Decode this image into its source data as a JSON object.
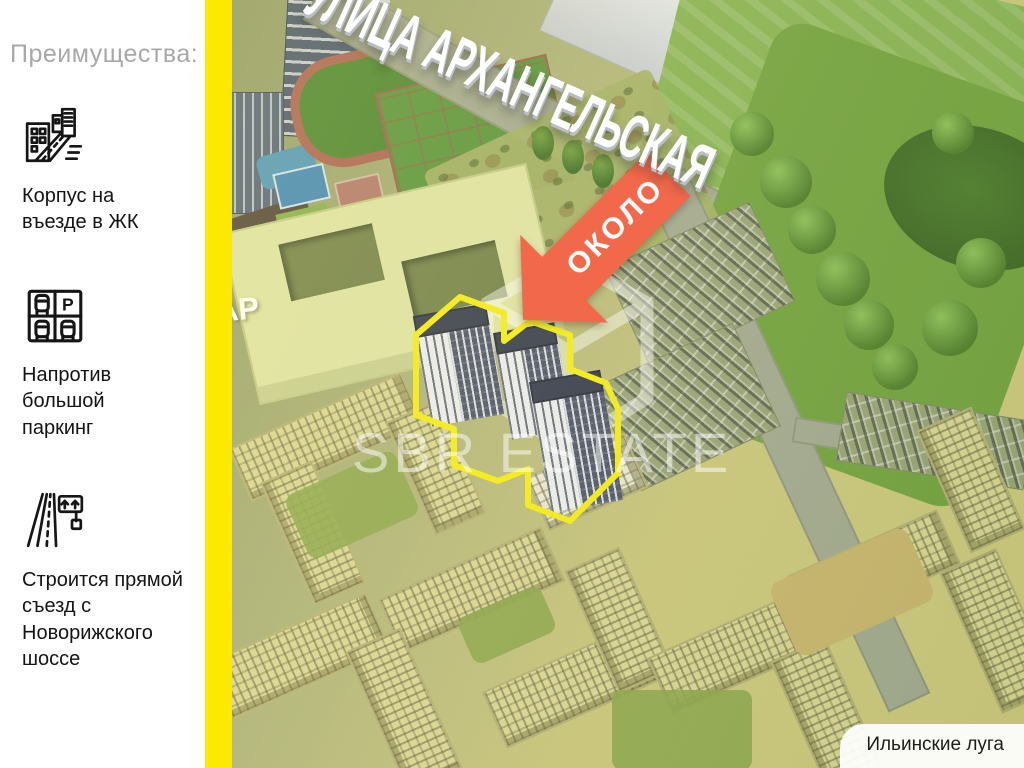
{
  "sidebar": {
    "title": "Преимущества:",
    "parking_letter": "P",
    "items": [
      {
        "icon": "buildings-road-icon",
        "label": "Корпус на\nвъезде в ЖК"
      },
      {
        "icon": "parking-icon",
        "label": "Напротив\nбольшой\nпаркинг"
      },
      {
        "icon": "highway-exit-icon",
        "label": "Строится прямой\nсъезд с\nНоворижского\nшоссе"
      }
    ]
  },
  "map": {
    "street_label": "УЛИЦА АРХАНГЕЛЬСКАЯ",
    "street_label_clipped": "АР",
    "arrow_label": "ОКОЛО",
    "watermark_text": "SBR ESTATE",
    "area_label": "Ильинские луга"
  },
  "colors": {
    "accent_yellow": "#FBEA00",
    "highlight_outline": "#F2EA14",
    "arrow_orange": "#F2684A",
    "sidebar_title_gray": "#A8A8A8"
  }
}
